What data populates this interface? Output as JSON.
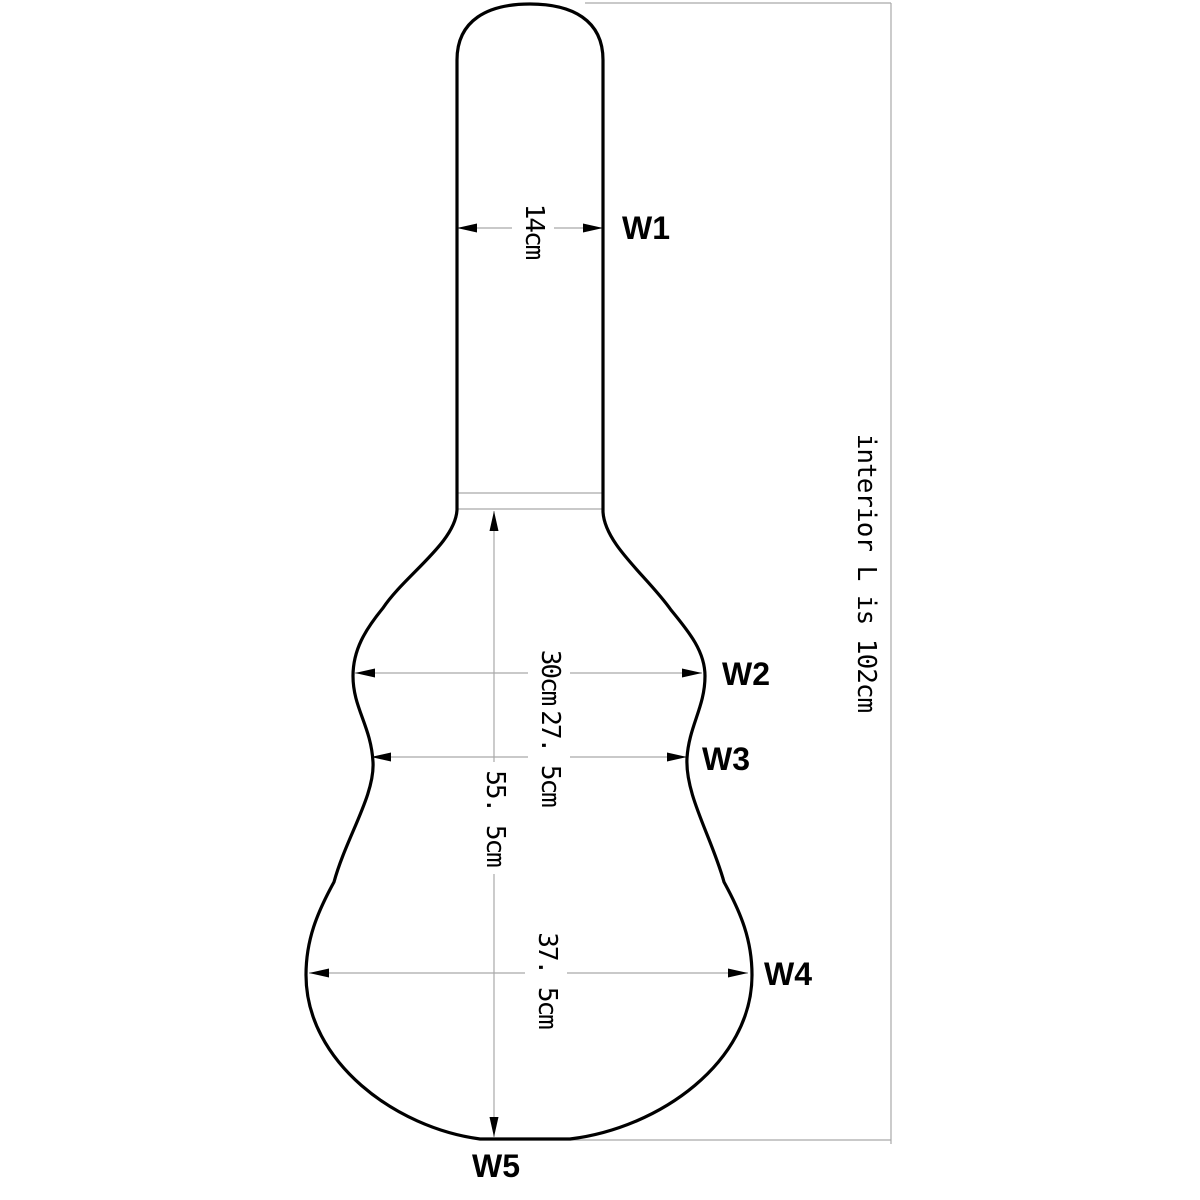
{
  "diagram": {
    "dimensions": {
      "w1": {
        "label": "W1",
        "value": "14cm"
      },
      "w2": {
        "label": "W2",
        "value": "30cm"
      },
      "w3": {
        "label": "W3",
        "value": "27. 5cm"
      },
      "w4": {
        "label": "W4",
        "value": "37. 5cm"
      },
      "w5": {
        "label": "W5"
      },
      "body_length": {
        "value": "55. 5cm"
      },
      "interior_length": {
        "note": "interior L is 102cm"
      }
    },
    "colors": {
      "outline": "#000000",
      "dimension_line": "#a9a9a9",
      "arrowhead": "#000000",
      "text": "#000000",
      "background": "#ffffff"
    }
  }
}
